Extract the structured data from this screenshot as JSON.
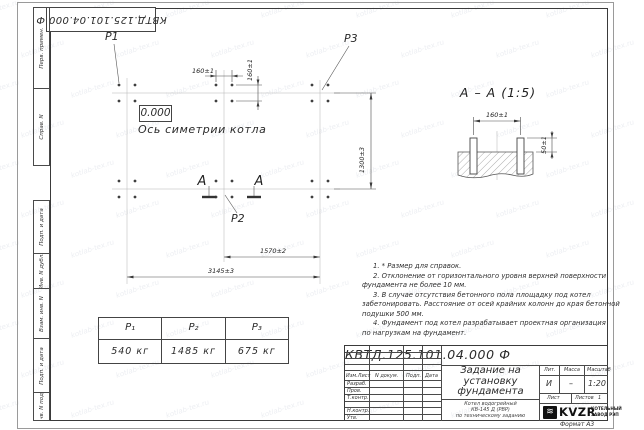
{
  "doc": {
    "number": "КВТД.125.101.04.000  Ф",
    "format_label": "Формат А3"
  },
  "watermark": "kotlab-tex.ru",
  "margins": {
    "top": [
      "Перв. примен.",
      "Справ. N"
    ],
    "bottom": [
      "Подп. и дата",
      "Инв. N дубл.",
      "Взам. инв. N",
      "Подп. и дата",
      "Инв. N подл."
    ]
  },
  "plan": {
    "p1": "Р1",
    "p2": "Р2",
    "p3": "Р3",
    "elevation": "0.000",
    "axis_label": "Ось симетрии котла",
    "section_letter": "А",
    "dims": {
      "h160": "160±1",
      "v160": "160±1",
      "v1300": "1300±3",
      "h1570": "1570±2",
      "h3145": "3145±3"
    }
  },
  "section": {
    "title": "А – А (1:5)",
    "dim_160": "160±1",
    "dim_50": "50±1"
  },
  "notes": [
    "1. * Размер для справок.",
    "2. Отклонение от горизонтального уровня верхней поверхности",
    "фундамента не более 10 мм.",
    "3. В случае отсутствия бетонного пола площадку под котел",
    "забетонировать. Расстояние от осей крайних колонн до края бетонной",
    "подушки 500 мм.",
    "4. Фундамент под котел разрабатывает проектная организация",
    "по нагрузкам на фундамент."
  ],
  "load_table": {
    "headers": [
      "Р₁",
      "Р₂",
      "Р₃"
    ],
    "values": [
      "540 кг",
      "1485 кг",
      "675 кг"
    ]
  },
  "title_block": {
    "cols": [
      "Изм.Лист",
      "N докум.",
      "Подп.",
      "Дата"
    ],
    "rows": [
      "Разраб.",
      "Пров.",
      "Т.контр.",
      "",
      "Н.контр.",
      "Утв."
    ],
    "title_lines": [
      "Задание на",
      "установку",
      "фундамента"
    ],
    "subtitle_lines": [
      "Котел водогрейный",
      "КВ-145 Д (РВР)",
      "по техническому заданию"
    ],
    "lit_label": "Лит.",
    "mass_label": "Масса",
    "scale_label": "Масштаб",
    "lit_value": "И",
    "mass_value": "–",
    "scale_value": "1:20",
    "sheet_label": "Лист",
    "sheets_label": "Листов",
    "sheets_value": "1",
    "logo_glyph": "≋",
    "logo_text": "KVZR",
    "logo_lines": [
      "КОТЕЛЬНЫЙ",
      "ЗАВОД РЭП"
    ]
  }
}
